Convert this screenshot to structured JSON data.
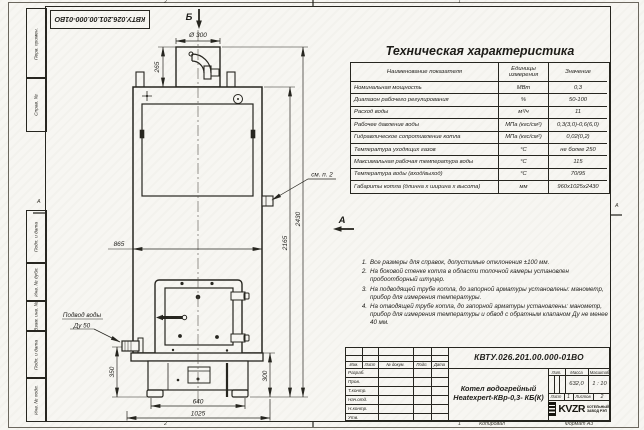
{
  "frame": {
    "zones_top": [
      "2",
      "1"
    ],
    "zones_bottom": [
      "2",
      "1"
    ],
    "zone_left": "А",
    "zone_right": "А",
    "top_stamp": "КВТУ.026.201.00.000-01ВО",
    "left_boxes": [
      "Перв. примен.",
      "Справ. №",
      "Подп. и дата",
      "Инв. № дубл.",
      "Взам. инв. №",
      "Подп. и дата",
      "Инв. № подл."
    ],
    "copied": "Копировал",
    "format": "Формат А3"
  },
  "spec_table": {
    "title": "Техническая характеристика",
    "headers": [
      "Наименование показателя",
      "Единицы измерения",
      "Значение"
    ],
    "rows": [
      {
        "name": "Номинальная мощность",
        "unit": "МВт",
        "value": "0,3"
      },
      {
        "name": "Диапазон рабочего регулирования",
        "unit": "%",
        "value": "50-100"
      },
      {
        "name": "Расход воды",
        "unit": "м³/ч",
        "value": "11"
      },
      {
        "name": "Рабочее давление воды",
        "unit": "МПа (кгс/см²)",
        "value": "0,3(3,0)-0,6(6,0)"
      },
      {
        "name": "Гидравлическое сопротивление котла",
        "unit": "МПа (кгс/см²)",
        "value": "0,02(0,2)"
      },
      {
        "name": "Температура уходящих газов",
        "unit": "°С",
        "value": "не более 250"
      },
      {
        "name": "Максимальная рабочая температура воды",
        "unit": "°С",
        "value": "115"
      },
      {
        "name": "Температура воды (вход/выход)",
        "unit": "°С",
        "value": "70/95"
      },
      {
        "name": "Габариты котла (длинна х ширина х высота)",
        "unit": "мм",
        "value": "960х1025х2430"
      }
    ]
  },
  "notes": [
    {
      "num": "1.",
      "text": "Все размеры для справок, допустимые отклонения ±100 мм."
    },
    {
      "num": "2.",
      "text": "На боковой стенке котла в области топочной камеры установлен пробоотборный штуцер."
    },
    {
      "num": "3.",
      "text": "На подводящей трубе котла, до запорной арматуры установлены: манометр, прибор для измерения температуры."
    },
    {
      "num": "4.",
      "text": "На отводящей трубе котла, до запорной арматуры установлены: манометр, прибор для измерения температуры и обвод с обратным клапаном Ду не менее 40 мм."
    }
  ],
  "drawing": {
    "labels": {
      "view_a": "А",
      "view_b": "Б",
      "see_note": "см. п. 2",
      "water_supply_1": "Подвод воды",
      "water_supply_2": "Ду 50"
    },
    "dims": {
      "d300": "Ø 300",
      "h265": "265",
      "w865": "865",
      "h2430": "2430",
      "h2165": "2165",
      "h350": "350",
      "h300": "300",
      "w640": "640",
      "w1025": "1025"
    }
  },
  "title_block": {
    "doc_number": "КВТУ.026.201.00.000-01ВО",
    "name_line1": "Котел водогрейный",
    "name_line2": "Heatexpert-КВр-0,3- КБ(К)",
    "col_headers": [
      "Изм.",
      "Лист",
      "№ докум.",
      "Подп.",
      "Дата"
    ],
    "sig_rows": [
      "Разраб.",
      "Пров.",
      "Т.контр.",
      "Нач.отд.",
      "Н.контр.",
      "Утв."
    ],
    "lit_label": "Лит.",
    "mass_label": "Масса",
    "scale_label": "Масштаб",
    "mass": "632,0",
    "scale": "1 : 10",
    "sheet_label": "Лист",
    "sheet": "1",
    "sheets_label": "Листов",
    "sheets": "2",
    "logo": "KVZR",
    "logo_sub1": "КОТЕЛЬНЫЙ",
    "logo_sub2": "ЗАВОД РЭП"
  }
}
